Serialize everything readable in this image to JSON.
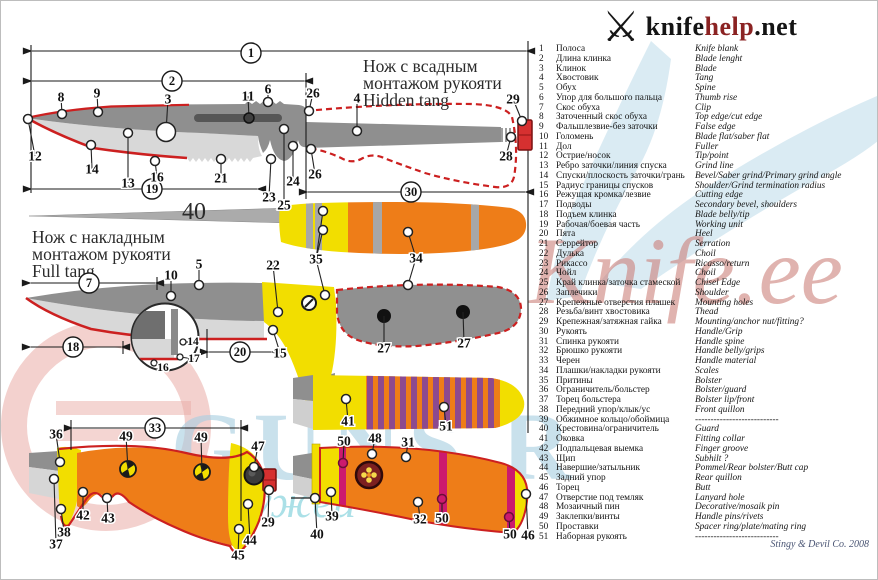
{
  "logo": {
    "brand_black": "knife",
    "brand_red": "help",
    "brand_suffix": ".net",
    "icon": "crossed-knives"
  },
  "titles": {
    "hidden_ru1": "Нож с всадным",
    "hidden_ru2": "монтажом рукояти",
    "hidden_en": "Hidden tang",
    "full_ru1": "Нож с накладным",
    "full_ru2": "монтажом рукояти",
    "full_en": "Full tang",
    "tang_number": "40"
  },
  "footer": {
    "credit": "Stingy & Devil Co. 2008"
  },
  "watermarks": {
    "blue_text": "GUNS.R",
    "teal_text": "ужей",
    "red_script": "Knife.ee"
  },
  "palette": {
    "blade_dark": "#8f8f8f",
    "blade_light": "#d8d8d8",
    "fuller": "#565656",
    "edge_red": "#cc2020",
    "orange": "#ee7d18",
    "yellow": "#f2de00",
    "magenta": "#cc1a6e",
    "purple": "#8d4a8f",
    "nut_red": "#d63030",
    "ink": "#1a1a1a",
    "wm_blue": "#aacfe2",
    "wm_red": "#cb7d76",
    "wm_teal": "#2fb4c4"
  },
  "legend": {
    "rows": [
      [
        "1",
        "Полоса",
        "Knife blank"
      ],
      [
        "2",
        "Длина клинка",
        "Blade lenght"
      ],
      [
        "3",
        "Клинок",
        "Blade"
      ],
      [
        "4",
        "Хвостовик",
        "Tang"
      ],
      [
        "5",
        "Обух",
        "Spine"
      ],
      [
        "6",
        "Упор для большого пальца",
        "Thumb rise"
      ],
      [
        "7",
        "Скос обуха",
        "Clip"
      ],
      [
        "8",
        "Заточенный скос обуха",
        "Top edge/cut edge"
      ],
      [
        "9",
        "Фальшлезвие-без заточки",
        "False edge"
      ],
      [
        "10",
        "Голомень",
        "Blade flat/saber flat"
      ],
      [
        "11",
        "Дол",
        "Fuller"
      ],
      [
        "12",
        "Острие/носок",
        "Tip/point"
      ],
      [
        "13",
        "Ребро заточки/линия спуска",
        "Grind line"
      ],
      [
        "14",
        "Спуски/плоскость заточки/грань",
        "Bevel/Saber grind/Primary grind angle"
      ],
      [
        "15",
        "Радиус границы спусков",
        "Shoulder/Grind termination radius"
      ],
      [
        "16",
        "Режущая кромка/лезвие",
        "Cutting edge"
      ],
      [
        "17",
        "Подводы",
        "Secondary bevel, shoulders"
      ],
      [
        "18",
        "Подъем клинка",
        "Blade belly/tip"
      ],
      [
        "19",
        "Рабочая/боевая часть",
        "Working unit"
      ],
      [
        "20",
        "Пята",
        "Heel"
      ],
      [
        "21",
        "Серрейтор",
        "Serration"
      ],
      [
        "22",
        "Дулька",
        "Choil"
      ],
      [
        "23",
        "Рикассо",
        "Ricasso/return"
      ],
      [
        "24",
        "Чойл",
        "Choil"
      ],
      [
        "25",
        "Край клинка/заточка стамеской",
        "Chisel Edge"
      ],
      [
        "26",
        "Заплечики",
        "Shoulder"
      ],
      [
        "27",
        "Крепежные отверстия плашек",
        "Mounting holes"
      ],
      [
        "28",
        "Резьба/винт хвостовика",
        "Thead"
      ],
      [
        "29",
        "Крепежная/затяжная гайка",
        "Mounting/anchor nut/fitting?"
      ],
      [
        "30",
        "Рукоять",
        "Handle/Grip"
      ],
      [
        "31",
        "Спинка рукояти",
        "Handle spine"
      ],
      [
        "32",
        "Брюшко рукояти",
        "Handle belly/grips"
      ],
      [
        "33",
        "Черен",
        "Handle material"
      ],
      [
        "34",
        "Плашки/накладки рукояти",
        "Scales"
      ],
      [
        "35",
        "Притины",
        "Bolster"
      ],
      [
        "36",
        "Ограничитель/больстер",
        "Bolster/guard"
      ],
      [
        "37",
        "Торец больстера",
        "Bolster lip/front"
      ],
      [
        "38",
        "Передний упор/клык/ус",
        "Front quillon"
      ],
      [
        "39",
        "Обжимное кольцо/обоймица",
        "---------------------------"
      ],
      [
        "40",
        "Крестовина/ограничитель",
        "Guard"
      ],
      [
        "41",
        "Оковка",
        "Fitting collar"
      ],
      [
        "42",
        "Подпальцевая выемка",
        "Finger groove"
      ],
      [
        "43",
        "Щип",
        "Subhilt ?"
      ],
      [
        "44",
        "Навершие/затыльник",
        "Pommel/Rear bolster/Butt cap"
      ],
      [
        "45",
        "Задний упор",
        "Rear quillon"
      ],
      [
        "46",
        "Торец",
        "Butt"
      ],
      [
        "47",
        "Отверстие под темляк",
        "Lanyard hole"
      ],
      [
        "48",
        "Мозаичный пин",
        "Decorative/mosaik pin"
      ],
      [
        "49",
        "Заклепки/винты",
        "Handle pins/rivets"
      ],
      [
        "50",
        "Проставки",
        "Spacer ring/plate/mating ring"
      ],
      [
        "51",
        "Наборная рукоять",
        "---------------------------"
      ]
    ]
  },
  "callouts": [
    {
      "n": "1",
      "x": 250,
      "y": 52,
      "c": 1
    },
    {
      "n": "2",
      "x": 171,
      "y": 80,
      "c": 1
    },
    {
      "n": "19",
      "x": 151,
      "y": 188,
      "c": 1
    },
    {
      "n": "30",
      "x": 410,
      "y": 191,
      "c": 1
    },
    {
      "n": "7",
      "x": 88,
      "y": 282,
      "c": 1
    },
    {
      "n": "18",
      "x": 72,
      "y": 346,
      "c": 1
    },
    {
      "n": "20",
      "x": 239,
      "y": 351,
      "c": 1
    },
    {
      "n": "33",
      "x": 154,
      "y": 427,
      "c": 1
    },
    {
      "n": "8",
      "x": 60,
      "y": 96,
      "m": [
        [
          61,
          113
        ]
      ]
    },
    {
      "n": "9",
      "x": 96,
      "y": 92,
      "m": [
        [
          97,
          111
        ]
      ]
    },
    {
      "n": "3",
      "x": 167,
      "y": 98,
      "m": [
        [
          165,
          131
        ]
      ],
      "ms": "big"
    },
    {
      "n": "11",
      "x": 247,
      "y": 95,
      "m": [
        [
          248,
          117
        ]
      ],
      "ms": "dark"
    },
    {
      "n": "6",
      "x": 267,
      "y": 88,
      "m": [
        [
          267,
          101
        ]
      ]
    },
    {
      "n": "12",
      "x": 34,
      "y": 155,
      "m": [
        [
          27,
          118
        ]
      ]
    },
    {
      "n": "14",
      "x": 91,
      "y": 168,
      "m": [
        [
          90,
          144
        ]
      ]
    },
    {
      "n": "13",
      "x": 127,
      "y": 182,
      "m": [
        [
          127,
          132
        ]
      ]
    },
    {
      "n": "16",
      "x": 156,
      "y": 176,
      "m": [
        [
          154,
          160
        ]
      ]
    },
    {
      "n": "21",
      "x": 220,
      "y": 177,
      "m": [
        [
          220,
          158
        ]
      ]
    },
    {
      "n": "23",
      "x": 268,
      "y": 196,
      "m": [
        [
          270,
          158
        ]
      ]
    },
    {
      "n": "25",
      "x": 283,
      "y": 204,
      "m": [
        [
          283,
          128
        ]
      ]
    },
    {
      "n": "24",
      "x": 292,
      "y": 180,
      "m": [
        [
          292,
          145
        ]
      ]
    },
    {
      "n": "26",
      "x": 312,
      "y": 92,
      "m": [
        [
          308,
          110
        ]
      ]
    },
    {
      "n": "26",
      "x": 314,
      "y": 173,
      "m": [
        [
          310,
          148
        ]
      ]
    },
    {
      "n": "4",
      "x": 356,
      "y": 97,
      "m": [
        [
          356,
          130
        ]
      ]
    },
    {
      "n": "29",
      "x": 512,
      "y": 98,
      "m": [
        [
          521,
          120
        ]
      ]
    },
    {
      "n": "28",
      "x": 505,
      "y": 155,
      "m": [
        [
          510,
          136
        ]
      ]
    },
    {
      "n": "35",
      "x": 315,
      "y": 258,
      "m": [
        [
          322,
          210
        ],
        [
          322,
          229
        ],
        [
          324,
          294
        ]
      ]
    },
    {
      "n": "34",
      "x": 415,
      "y": 257,
      "m": [
        [
          407,
          231
        ],
        [
          407,
          284
        ]
      ]
    },
    {
      "n": "5",
      "x": 198,
      "y": 263,
      "m": [
        [
          198,
          284
        ]
      ]
    },
    {
      "n": "10",
      "x": 170,
      "y": 274,
      "m": [
        [
          170,
          295
        ]
      ]
    },
    {
      "n": "22",
      "x": 272,
      "y": 264,
      "m": [
        [
          277,
          311
        ]
      ]
    },
    {
      "n": "15",
      "x": 279,
      "y": 352,
      "m": [
        [
          272,
          329
        ]
      ]
    },
    {
      "n": "27",
      "x": 383,
      "y": 347,
      "m": [
        [
          383,
          315
        ]
      ],
      "ms": "none"
    },
    {
      "n": "27",
      "x": 463,
      "y": 342,
      "m": [
        [
          462,
          311
        ]
      ],
      "ms": "none"
    },
    {
      "n": "14",
      "x": 192,
      "y": 341,
      "m": [
        [
          182,
          341
        ]
      ],
      "small": 1
    },
    {
      "n": "17",
      "x": 193,
      "y": 358,
      "m": [
        [
          179,
          356
        ]
      ],
      "small": 1
    },
    {
      "n": "16",
      "x": 162,
      "y": 367,
      "m": [
        [
          153,
          362
        ]
      ],
      "small": 1
    },
    {
      "n": "36",
      "x": 55,
      "y": 433,
      "m": [
        [
          59,
          461
        ]
      ]
    },
    {
      "n": "49",
      "x": 125,
      "y": 435,
      "m": [
        [
          127,
          468
        ]
      ],
      "ms": "none"
    },
    {
      "n": "49",
      "x": 200,
      "y": 436,
      "m": [
        [
          201,
          471
        ]
      ],
      "ms": "none"
    },
    {
      "n": "47",
      "x": 257,
      "y": 445,
      "m": [
        [
          253,
          466
        ]
      ]
    },
    {
      "n": "42",
      "x": 82,
      "y": 514,
      "m": [
        [
          82,
          491
        ]
      ]
    },
    {
      "n": "43",
      "x": 107,
      "y": 517,
      "m": [
        [
          106,
          497
        ]
      ]
    },
    {
      "n": "38",
      "x": 63,
      "y": 531,
      "m": [
        [
          60,
          508
        ]
      ]
    },
    {
      "n": "37",
      "x": 55,
      "y": 543,
      "m": [
        [
          53,
          478
        ]
      ]
    },
    {
      "n": "29",
      "x": 267,
      "y": 521,
      "m": [
        [
          268,
          489
        ]
      ]
    },
    {
      "n": "44",
      "x": 249,
      "y": 539,
      "m": [
        [
          247,
          503
        ]
      ]
    },
    {
      "n": "45",
      "x": 237,
      "y": 554,
      "m": [
        [
          238,
          528
        ]
      ]
    },
    {
      "n": "41",
      "x": 347,
      "y": 420,
      "m": [
        [
          345,
          398
        ]
      ]
    },
    {
      "n": "51",
      "x": 445,
      "y": 425,
      "m": [
        [
          443,
          406
        ]
      ]
    },
    {
      "n": "50",
      "x": 343,
      "y": 440,
      "m": [
        [
          342,
          462
        ]
      ],
      "ms": "mag"
    },
    {
      "n": "48",
      "x": 374,
      "y": 437,
      "m": [
        [
          371,
          453
        ]
      ]
    },
    {
      "n": "31",
      "x": 407,
      "y": 441,
      "m": [
        [
          405,
          456
        ]
      ]
    },
    {
      "n": "39",
      "x": 331,
      "y": 515,
      "m": [
        [
          330,
          491
        ]
      ]
    },
    {
      "n": "40",
      "x": 316,
      "y": 533,
      "m": [
        [
          314,
          497
        ]
      ]
    },
    {
      "n": "32",
      "x": 419,
      "y": 518,
      "m": [
        [
          417,
          501
        ]
      ]
    },
    {
      "n": "50",
      "x": 441,
      "y": 517,
      "m": [
        [
          441,
          498
        ]
      ],
      "ms": "mag"
    },
    {
      "n": "50",
      "x": 509,
      "y": 533,
      "m": [
        [
          508,
          516
        ]
      ],
      "ms": "mag"
    },
    {
      "n": "46",
      "x": 527,
      "y": 534,
      "m": [
        [
          525,
          493
        ]
      ]
    }
  ],
  "features": [
    {
      "type": "nut",
      "x": 517,
      "y": 119,
      "w": 14,
      "h": 30
    },
    {
      "type": "nut",
      "x": 262,
      "y": 468,
      "w": 13,
      "h": 22
    },
    {
      "type": "rivet",
      "x": 127,
      "y": 468
    },
    {
      "type": "rivet",
      "x": 201,
      "y": 471
    },
    {
      "type": "lanyard-hole",
      "x": 253,
      "y": 474
    },
    {
      "type": "mosaic-pin",
      "x": 368,
      "y": 474
    },
    {
      "type": "screw",
      "x": 308,
      "y": 302
    },
    {
      "type": "hole",
      "x": 383,
      "y": 315
    },
    {
      "type": "hole",
      "x": 462,
      "y": 311
    }
  ]
}
